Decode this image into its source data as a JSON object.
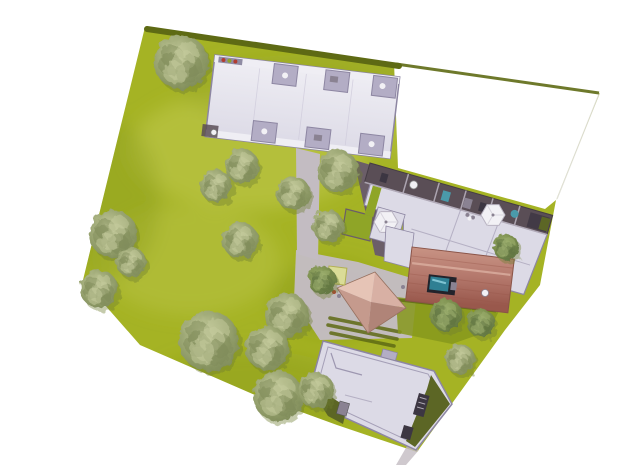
{
  "scene": {
    "type": "aerial-site-plan-rendering",
    "legend": [
      "lawn-parcel",
      "boundary-hedge",
      "empty-lot",
      "north-apartment-building",
      "east-apartment-building",
      "red-tile-roof-building",
      "hip-roof-house",
      "south-apartment-building",
      "courtyard-paths",
      "hedge-rows",
      "patio-umbrellas",
      "trees"
    ],
    "colors": {
      "background": "#ffffff",
      "lawn": "#a5b324",
      "lawn_light": "#c3cc52",
      "lawn_dark": "#86981c",
      "hedge": "#5e6a14",
      "tree_main": "#99a471",
      "tree_light": "#c6cc9d",
      "tree_dark": "#7d8a57",
      "tree_green_main": "#7d904f",
      "tree_green_light": "#9db06f",
      "tree_green_dark": "#5d7240",
      "shadow": "#6e7c33",
      "roof_light": "#dcdae6",
      "roof_band": "#efeef4",
      "wall": "#8d86a2",
      "recess": "#b3adc5",
      "terrace_dark": "#5a4e56",
      "path": "#c3bcc2",
      "path_dark": "#6b5e68",
      "brick": "#b4786c",
      "brick_light": "#c89384",
      "brick_dark": "#99584c",
      "ridge": "#d7aa9b",
      "skylight": "#2f7f93",
      "skylight_light": "#7fc3d2",
      "hip_pale": "#e6c4b6",
      "hip_light": "#d8b0a4",
      "hip_mid": "#c59a8d",
      "hip_dark": "#b08478",
      "canopy": "#dadc97",
      "green_roof": "#5c6625",
      "hedge_square": "#8fa527",
      "furniture_white": "#f2f1f5",
      "furniture_gray": "#8a8292",
      "furniture_dark": "#3c3642",
      "accent_teal": "#4a9aaa",
      "accent_red": "#b23c30"
    },
    "trees": [
      {
        "x": 181,
        "y": 62,
        "r": 27,
        "p": "o"
      },
      {
        "x": 242,
        "y": 166,
        "r": 17,
        "p": "o"
      },
      {
        "x": 216,
        "y": 186,
        "r": 16,
        "p": "o"
      },
      {
        "x": 293,
        "y": 193,
        "r": 17,
        "p": "o"
      },
      {
        "x": 338,
        "y": 171,
        "r": 21,
        "p": "o"
      },
      {
        "x": 328,
        "y": 226,
        "r": 16,
        "p": "o"
      },
      {
        "x": 240,
        "y": 240,
        "r": 18,
        "p": "o"
      },
      {
        "x": 113,
        "y": 234,
        "r": 24,
        "p": "o"
      },
      {
        "x": 131,
        "y": 262,
        "r": 15,
        "p": "o"
      },
      {
        "x": 99,
        "y": 289,
        "r": 19,
        "p": "o"
      },
      {
        "x": 209,
        "y": 341,
        "r": 30,
        "p": "o"
      },
      {
        "x": 287,
        "y": 315,
        "r": 22,
        "p": "o"
      },
      {
        "x": 267,
        "y": 348,
        "r": 22,
        "p": "o"
      },
      {
        "x": 278,
        "y": 396,
        "r": 25,
        "p": "o"
      },
      {
        "x": 316,
        "y": 390,
        "r": 18,
        "p": "o"
      },
      {
        "x": 460,
        "y": 359,
        "r": 15,
        "p": "o"
      },
      {
        "x": 322,
        "y": 280,
        "r": 14,
        "p": "g"
      },
      {
        "x": 446,
        "y": 315,
        "r": 16,
        "p": "g"
      },
      {
        "x": 481,
        "y": 323,
        "r": 14,
        "p": "g"
      },
      {
        "x": 506,
        "y": 247,
        "r": 13,
        "p": "g"
      }
    ]
  }
}
